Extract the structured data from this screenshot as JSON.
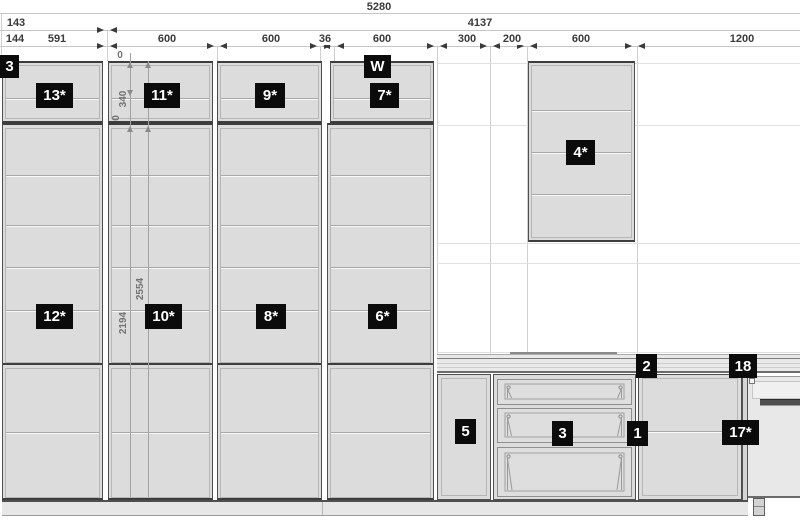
{
  "colors": {
    "badge_bg": "#0b0b0b",
    "badge_text": "#ffffff",
    "cabinet_fill": "#dcdcdd",
    "line_dark": "#3d3d3d",
    "line_light": "#b6b6b6",
    "dim_text": "#3a3a3a",
    "wall_line": "#e0e0e0"
  },
  "dimensions": {
    "horizontal_rows": [
      {
        "name": "overall",
        "line_y": 13,
        "labels": [
          {
            "text": "5280",
            "x": 379,
            "y": 1
          }
        ]
      },
      {
        "name": "sub",
        "line_y": 30,
        "labels": [
          {
            "text": "143",
            "x": 16,
            "y": 17
          },
          {
            "text": "4137",
            "x": 480,
            "y": 17
          }
        ]
      },
      {
        "name": "segments",
        "line_y": 46,
        "labels": [
          {
            "text": "144",
            "x": 15,
            "y": 33
          },
          {
            "text": "591",
            "x": 57,
            "y": 33
          },
          {
            "text": "600",
            "x": 167,
            "y": 33
          },
          {
            "text": "600",
            "x": 271,
            "y": 33
          },
          {
            "text": "36",
            "x": 325,
            "y": 33
          },
          {
            "text": "600",
            "x": 382,
            "y": 33
          },
          {
            "text": "300",
            "x": 467,
            "y": 33
          },
          {
            "text": "200",
            "x": 512,
            "y": 33
          },
          {
            "text": "600",
            "x": 581,
            "y": 33
          },
          {
            "text": "1200",
            "x": 742,
            "y": 33
          }
        ]
      }
    ],
    "arrow_pairs": {
      "row2": [
        107
      ],
      "row3": [
        107,
        217,
        320,
        334,
        437,
        490,
        527,
        635
      ]
    },
    "extension_lines": [
      {
        "x": 1,
        "y1": 13,
        "y2": 61
      },
      {
        "x": 107,
        "y1": 30,
        "y2": 61
      },
      {
        "x": 217,
        "y1": 46,
        "y2": 61
      },
      {
        "x": 320,
        "y1": 46,
        "y2": 61
      },
      {
        "x": 334,
        "y1": 46,
        "y2": 61
      },
      {
        "x": 437,
        "y1": 46,
        "y2": 354
      },
      {
        "x": 490,
        "y1": 46,
        "y2": 372
      },
      {
        "x": 527,
        "y1": 46,
        "y2": 354
      },
      {
        "x": 637,
        "y1": 46,
        "y2": 354
      }
    ],
    "wall_lines": [
      {
        "y": 63,
        "x1": 437,
        "x2": 800
      },
      {
        "y": 125,
        "x1": 437,
        "x2": 800
      },
      {
        "y": 243,
        "x1": 437,
        "x2": 800
      },
      {
        "y": 263,
        "x1": 437,
        "x2": 800
      },
      {
        "y": 352,
        "x1": 437,
        "x2": 800
      }
    ],
    "vertical_labels": [
      {
        "text": "0",
        "x": 120,
        "y": 56,
        "rotated": false
      },
      {
        "text": "340",
        "x": 124,
        "y": 99,
        "rotated": true
      },
      {
        "text": "0",
        "x": 117,
        "y": 118,
        "rotated": true
      },
      {
        "text": "2554",
        "x": 141,
        "y": 289,
        "rotated": true
      },
      {
        "text": "2194",
        "x": 124,
        "y": 323,
        "rotated": true
      }
    ],
    "vertical_ticks": [
      {
        "x": 130,
        "y": 62,
        "dir": "up"
      },
      {
        "x": 148,
        "y": 62,
        "dir": "up"
      },
      {
        "x": 130,
        "y": 90,
        "dir": "dn"
      },
      {
        "x": 130,
        "y": 126,
        "dir": "up"
      },
      {
        "x": 148,
        "y": 126,
        "dir": "up"
      }
    ]
  },
  "badges": [
    {
      "id": "3-top",
      "label": "3",
      "x": 0,
      "y": 55,
      "w": 19,
      "h": 23
    },
    {
      "id": "w",
      "label": "W",
      "x": 364,
      "y": 55,
      "w": 27,
      "h": 23
    },
    {
      "id": "13",
      "label": "13*",
      "x": 36,
      "y": 83,
      "w": 37,
      "h": 25
    },
    {
      "id": "11",
      "label": "11*",
      "x": 144,
      "y": 83,
      "w": 36,
      "h": 25
    },
    {
      "id": "9",
      "label": "9*",
      "x": 255,
      "y": 83,
      "w": 30,
      "h": 25
    },
    {
      "id": "7",
      "label": "7*",
      "x": 370,
      "y": 83,
      "w": 29,
      "h": 25
    },
    {
      "id": "4",
      "label": "4*",
      "x": 566,
      "y": 140,
      "w": 29,
      "h": 25
    },
    {
      "id": "12",
      "label": "12*",
      "x": 36,
      "y": 304,
      "w": 37,
      "h": 25
    },
    {
      "id": "10",
      "label": "10*",
      "x": 145,
      "y": 304,
      "w": 37,
      "h": 25
    },
    {
      "id": "8",
      "label": "8*",
      "x": 256,
      "y": 304,
      "w": 30,
      "h": 25
    },
    {
      "id": "6",
      "label": "6*",
      "x": 368,
      "y": 304,
      "w": 29,
      "h": 25
    },
    {
      "id": "5",
      "label": "5",
      "x": 455,
      "y": 419,
      "w": 21,
      "h": 25
    },
    {
      "id": "3-base",
      "label": "3",
      "x": 552,
      "y": 421,
      "w": 21,
      "h": 25
    },
    {
      "id": "1",
      "label": "1",
      "x": 627,
      "y": 421,
      "w": 21,
      "h": 25
    },
    {
      "id": "17",
      "label": "17*",
      "x": 722,
      "y": 420,
      "w": 37,
      "h": 25
    },
    {
      "id": "2",
      "label": "2",
      "x": 636,
      "y": 354,
      "w": 21,
      "h": 24
    },
    {
      "id": "18",
      "label": "18",
      "x": 729,
      "y": 354,
      "w": 28,
      "h": 24
    }
  ]
}
